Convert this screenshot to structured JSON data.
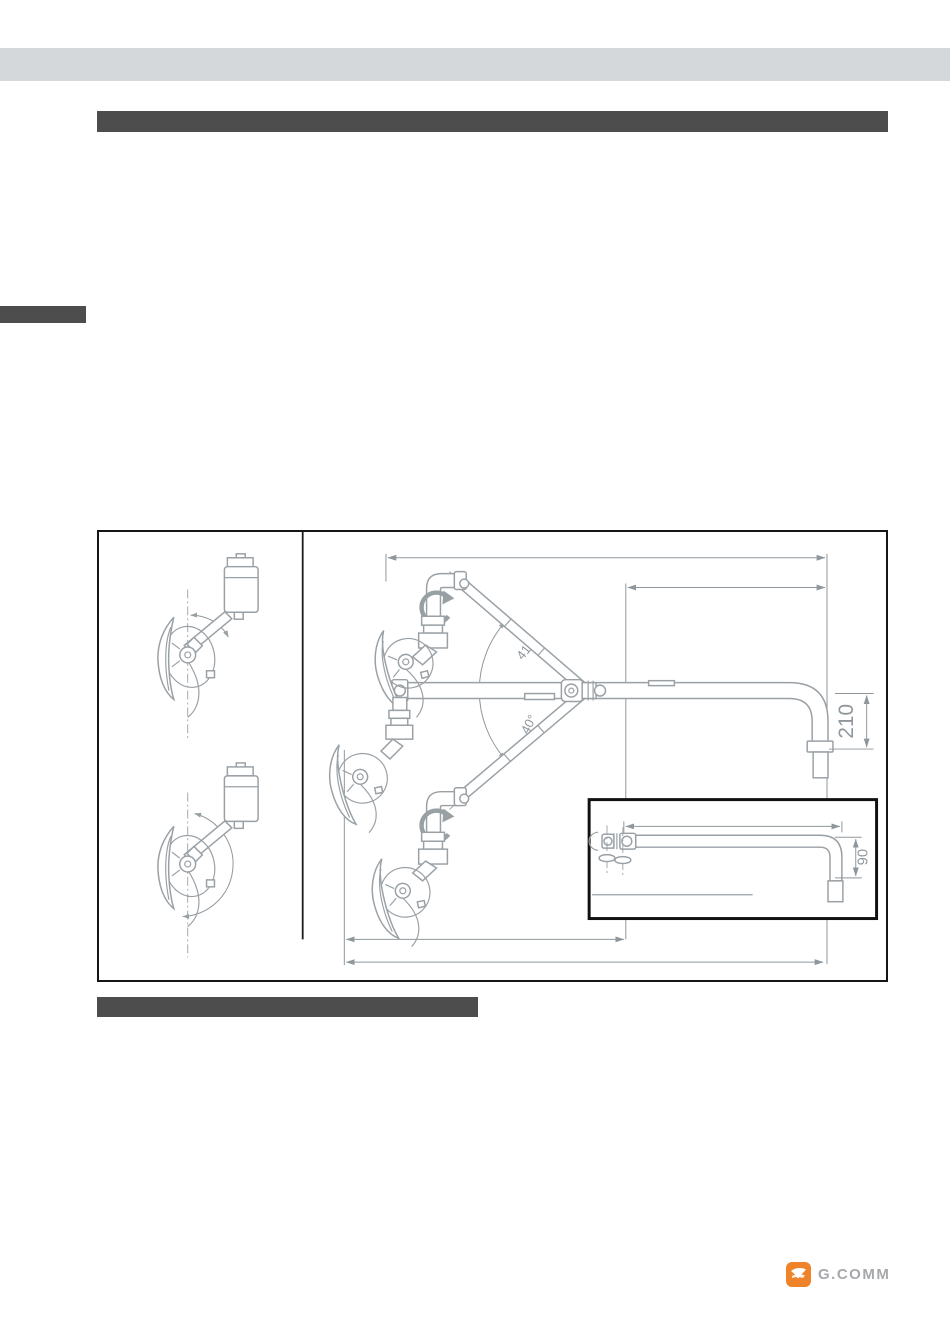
{
  "drawing": {
    "angle_upper_label": "41°",
    "angle_lower_label": "40°",
    "dim_pipe_drop_label": "210",
    "inset_dim_label": "90"
  },
  "footer": {
    "brand": "G.COMM"
  },
  "colors": {
    "accent_orange": "#ef8329",
    "redaction_bar": "#4d4d4d",
    "top_band_gray": "#d5d8db",
    "drawing_line_gray": "#9aa1a6",
    "dimension_gray": "#8f979c"
  }
}
